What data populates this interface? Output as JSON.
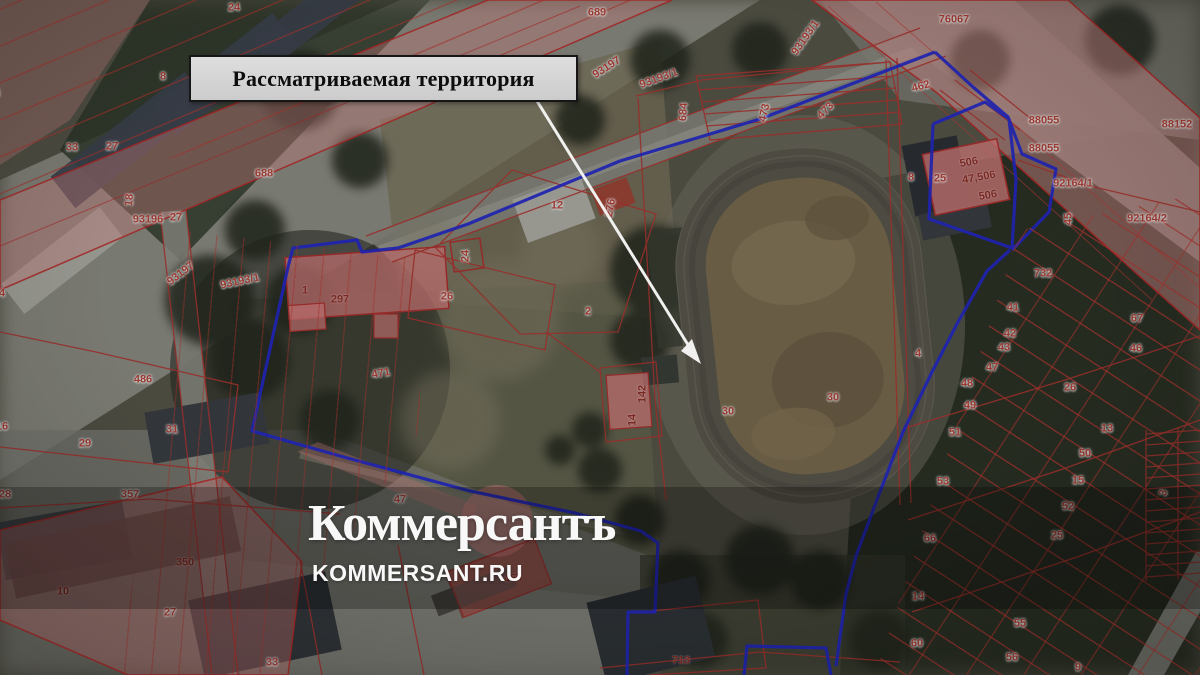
{
  "annotation": {
    "territory_label": "Рассматриваемая территория"
  },
  "watermark": {
    "logo_text": "Коммерсантъ",
    "site_text": "KOMMERSANT.RU"
  },
  "map": {
    "type": "cadastral-satellite",
    "colors": {
      "boundary_blue": "#2328cf",
      "parcel_line_red": "#b23632",
      "parcel_fill_pink": "#dd8c8c",
      "arrow_white": "#f0f0ee",
      "watermark_white": "#ffffff",
      "label_box_bg": "#d6d6d3",
      "label_box_border": "#161616"
    },
    "parcel_labels": [
      {
        "t": "24",
        "x": 234,
        "y": 8
      },
      {
        "t": "689",
        "x": 597,
        "y": 13
      },
      {
        "t": "76067",
        "x": 954,
        "y": 20
      },
      {
        "t": "93193/1",
        "x": 806,
        "y": 38,
        "r": -55
      },
      {
        "t": "93197",
        "x": 607,
        "y": 68,
        "r": -33
      },
      {
        "t": "93193/1",
        "x": 659,
        "y": 79,
        "r": -20
      },
      {
        "t": "8",
        "x": 163,
        "y": 77
      },
      {
        "t": "684",
        "x": 684,
        "y": 112,
        "r": -85
      },
      {
        "t": "473",
        "x": 765,
        "y": 113,
        "r": -78
      },
      {
        "t": "473",
        "x": 826,
        "y": 111,
        "r": -45
      },
      {
        "t": "462",
        "x": 921,
        "y": 87,
        "r": -15
      },
      {
        "t": "88055",
        "x": 1044,
        "y": 121
      },
      {
        "t": "88152",
        "x": 1177,
        "y": 125
      },
      {
        "t": "88055",
        "x": 1044,
        "y": 149
      },
      {
        "t": "33",
        "x": -6,
        "y": 94
      },
      {
        "t": "33",
        "x": 72,
        "y": 148
      },
      {
        "t": "27",
        "x": 112,
        "y": 147
      },
      {
        "t": "688",
        "x": 264,
        "y": 174
      },
      {
        "t": "506",
        "x": 969,
        "y": 163,
        "r": -10,
        "s": 2
      },
      {
        "t": "47,506",
        "x": 979,
        "y": 178,
        "r": -10,
        "s": 2
      },
      {
        "t": "8",
        "x": 911,
        "y": 178
      },
      {
        "t": "25",
        "x": 940,
        "y": 179
      },
      {
        "t": "506",
        "x": 988,
        "y": 196,
        "r": -10,
        "s": 2
      },
      {
        "t": "35",
        "x": -8,
        "y": 186
      },
      {
        "t": "92164/1",
        "x": 1073,
        "y": 184
      },
      {
        "t": "12",
        "x": 557,
        "y": 206
      },
      {
        "t": "276",
        "x": 611,
        "y": 208,
        "r": -80
      },
      {
        "t": "18",
        "x": 130,
        "y": 200,
        "r": -85
      },
      {
        "t": "93196",
        "x": 148,
        "y": 220
      },
      {
        "t": "27",
        "x": 176,
        "y": 218
      },
      {
        "t": "92164/2",
        "x": 1147,
        "y": 219
      },
      {
        "t": "45",
        "x": 1069,
        "y": 219,
        "r": -90
      },
      {
        "t": "24",
        "x": 466,
        "y": 256,
        "r": -90
      },
      {
        "t": "93197",
        "x": 181,
        "y": 274,
        "r": -38
      },
      {
        "t": "732",
        "x": 1043,
        "y": 274
      },
      {
        "t": "93193/1",
        "x": 240,
        "y": 282,
        "r": -12
      },
      {
        "t": "1",
        "x": 305,
        "y": 291,
        "s": 2
      },
      {
        "t": "297",
        "x": 340,
        "y": 300,
        "s": 2
      },
      {
        "t": "394",
        "x": -4,
        "y": 294
      },
      {
        "t": "26",
        "x": 447,
        "y": 297
      },
      {
        "t": "41",
        "x": 1013,
        "y": 308
      },
      {
        "t": "2",
        "x": 588,
        "y": 312
      },
      {
        "t": "67",
        "x": 1137,
        "y": 319
      },
      {
        "t": "42",
        "x": 1010,
        "y": 334
      },
      {
        "t": "43",
        "x": 1004,
        "y": 348
      },
      {
        "t": "46",
        "x": 1136,
        "y": 349
      },
      {
        "t": "4",
        "x": 918,
        "y": 354
      },
      {
        "t": "47",
        "x": 992,
        "y": 368
      },
      {
        "t": "471",
        "x": 381,
        "y": 374,
        "r": -10
      },
      {
        "t": "486",
        "x": 143,
        "y": 380
      },
      {
        "t": "48",
        "x": 967,
        "y": 384
      },
      {
        "t": "26",
        "x": 1070,
        "y": 388
      },
      {
        "t": "142",
        "x": 643,
        "y": 394,
        "r": -90,
        "s": 2
      },
      {
        "t": "30",
        "x": 833,
        "y": 398
      },
      {
        "t": "49",
        "x": 970,
        "y": 406
      },
      {
        "t": "30",
        "x": 728,
        "y": 412
      },
      {
        "t": "14",
        "x": 633,
        "y": 420,
        "r": -90,
        "s": 2
      },
      {
        "t": "16",
        "x": 2,
        "y": 427
      },
      {
        "t": "31",
        "x": 172,
        "y": 430
      },
      {
        "t": "13",
        "x": 1107,
        "y": 429
      },
      {
        "t": "51",
        "x": 955,
        "y": 433
      },
      {
        "t": "29",
        "x": 85,
        "y": 444
      },
      {
        "t": "50",
        "x": 1085,
        "y": 454
      },
      {
        "t": "15",
        "x": 1078,
        "y": 481
      },
      {
        "t": "53",
        "x": 943,
        "y": 482
      },
      {
        "t": "3",
        "x": 1164,
        "y": 493,
        "r": -75
      },
      {
        "t": "28",
        "x": 5,
        "y": 495
      },
      {
        "t": "357",
        "x": 130,
        "y": 495
      },
      {
        "t": "47",
        "x": 400,
        "y": 500
      },
      {
        "t": "52",
        "x": 1068,
        "y": 507
      },
      {
        "t": "25",
        "x": 1057,
        "y": 536
      },
      {
        "t": "66",
        "x": 930,
        "y": 539
      },
      {
        "t": "350",
        "x": 185,
        "y": 563,
        "s": 2
      },
      {
        "t": "465",
        "x": 513,
        "y": 579,
        "r": -8,
        "s": 2
      },
      {
        "t": "10",
        "x": 63,
        "y": 592,
        "s": 2
      },
      {
        "t": "14",
        "x": 918,
        "y": 597
      },
      {
        "t": "27",
        "x": 170,
        "y": 613
      },
      {
        "t": "55",
        "x": 1020,
        "y": 624
      },
      {
        "t": "60",
        "x": 917,
        "y": 644
      },
      {
        "t": "56",
        "x": 1012,
        "y": 658
      },
      {
        "t": "713",
        "x": 681,
        "y": 661,
        "s": 2
      },
      {
        "t": "33",
        "x": 272,
        "y": 663
      },
      {
        "t": "9",
        "x": 1078,
        "y": 668
      }
    ]
  }
}
